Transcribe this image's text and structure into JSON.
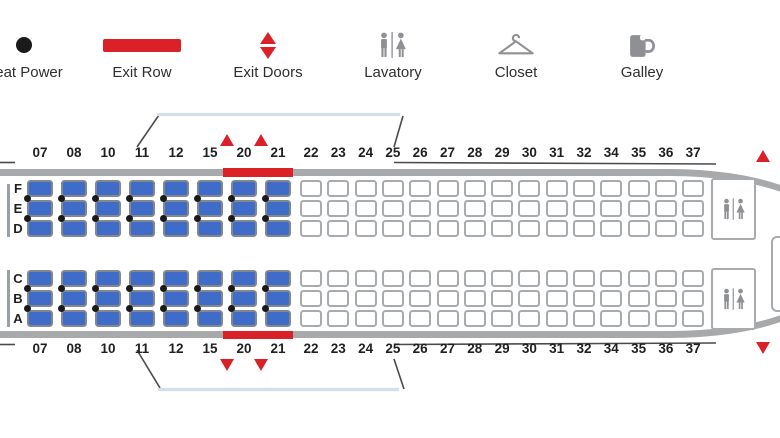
{
  "legend": {
    "items": [
      {
        "id": "seat-power",
        "label": "Seat Power"
      },
      {
        "id": "exit-row",
        "label": "Exit Row"
      },
      {
        "id": "exit-doors",
        "label": "Exit Doors"
      },
      {
        "id": "lavatory",
        "label": "Lavatory"
      },
      {
        "id": "closet",
        "label": "Closet"
      },
      {
        "id": "galley",
        "label": "Galley"
      }
    ]
  },
  "cabin": {
    "letters_top": [
      "F",
      "E",
      "D"
    ],
    "letters_bottom": [
      "C",
      "B",
      "A"
    ],
    "rows": [
      {
        "number": "07",
        "type": "premium",
        "power": true,
        "exit_row": false
      },
      {
        "number": "08",
        "type": "premium",
        "power": true,
        "exit_row": false
      },
      {
        "number": "10",
        "type": "premium",
        "power": true,
        "exit_row": false
      },
      {
        "number": "11",
        "type": "premium",
        "power": true,
        "exit_row": false
      },
      {
        "number": "12",
        "type": "premium",
        "power": true,
        "exit_row": false
      },
      {
        "number": "15",
        "type": "premium",
        "power": true,
        "exit_row": false
      },
      {
        "number": "20",
        "type": "premium",
        "power": true,
        "exit_row": true
      },
      {
        "number": "21",
        "type": "premium",
        "power": true,
        "exit_row": true
      },
      {
        "number": "22",
        "type": "standard",
        "power": false,
        "exit_row": false
      },
      {
        "number": "23",
        "type": "standard",
        "power": false,
        "exit_row": false
      },
      {
        "number": "24",
        "type": "standard",
        "power": false,
        "exit_row": false
      },
      {
        "number": "25",
        "type": "standard",
        "power": false,
        "exit_row": false
      },
      {
        "number": "26",
        "type": "standard",
        "power": false,
        "exit_row": false
      },
      {
        "number": "27",
        "type": "standard",
        "power": false,
        "exit_row": false
      },
      {
        "number": "28",
        "type": "standard",
        "power": false,
        "exit_row": false
      },
      {
        "number": "29",
        "type": "standard",
        "power": false,
        "exit_row": false
      },
      {
        "number": "30",
        "type": "standard",
        "power": false,
        "exit_row": false
      },
      {
        "number": "31",
        "type": "standard",
        "power": false,
        "exit_row": false
      },
      {
        "number": "32",
        "type": "standard",
        "power": false,
        "exit_row": false
      },
      {
        "number": "34",
        "type": "standard",
        "power": false,
        "exit_row": false
      },
      {
        "number": "35",
        "type": "standard",
        "power": false,
        "exit_row": false
      },
      {
        "number": "36",
        "type": "standard",
        "power": false,
        "exit_row": false
      },
      {
        "number": "37",
        "type": "standard",
        "power": false,
        "exit_row": false
      }
    ],
    "exit_doors": [
      {
        "location": "between-rows-15-20"
      },
      {
        "location": "between-rows-20-21"
      },
      {
        "location": "rear"
      }
    ],
    "facilities": [
      {
        "type": "lavatory",
        "position": "rear-upper"
      },
      {
        "type": "lavatory",
        "position": "rear-lower"
      },
      {
        "type": "galley",
        "position": "tail"
      }
    ]
  },
  "colors": {
    "premium_seat": "#3e6cc8",
    "standard_seat": "#ffffff",
    "exit_red": "#da2128",
    "fuselage_wall": "#a7a9ab",
    "wing_edge": "#d3e0ec",
    "icon_gray": "#8e9093",
    "power_dot": "#1a1a1a"
  }
}
